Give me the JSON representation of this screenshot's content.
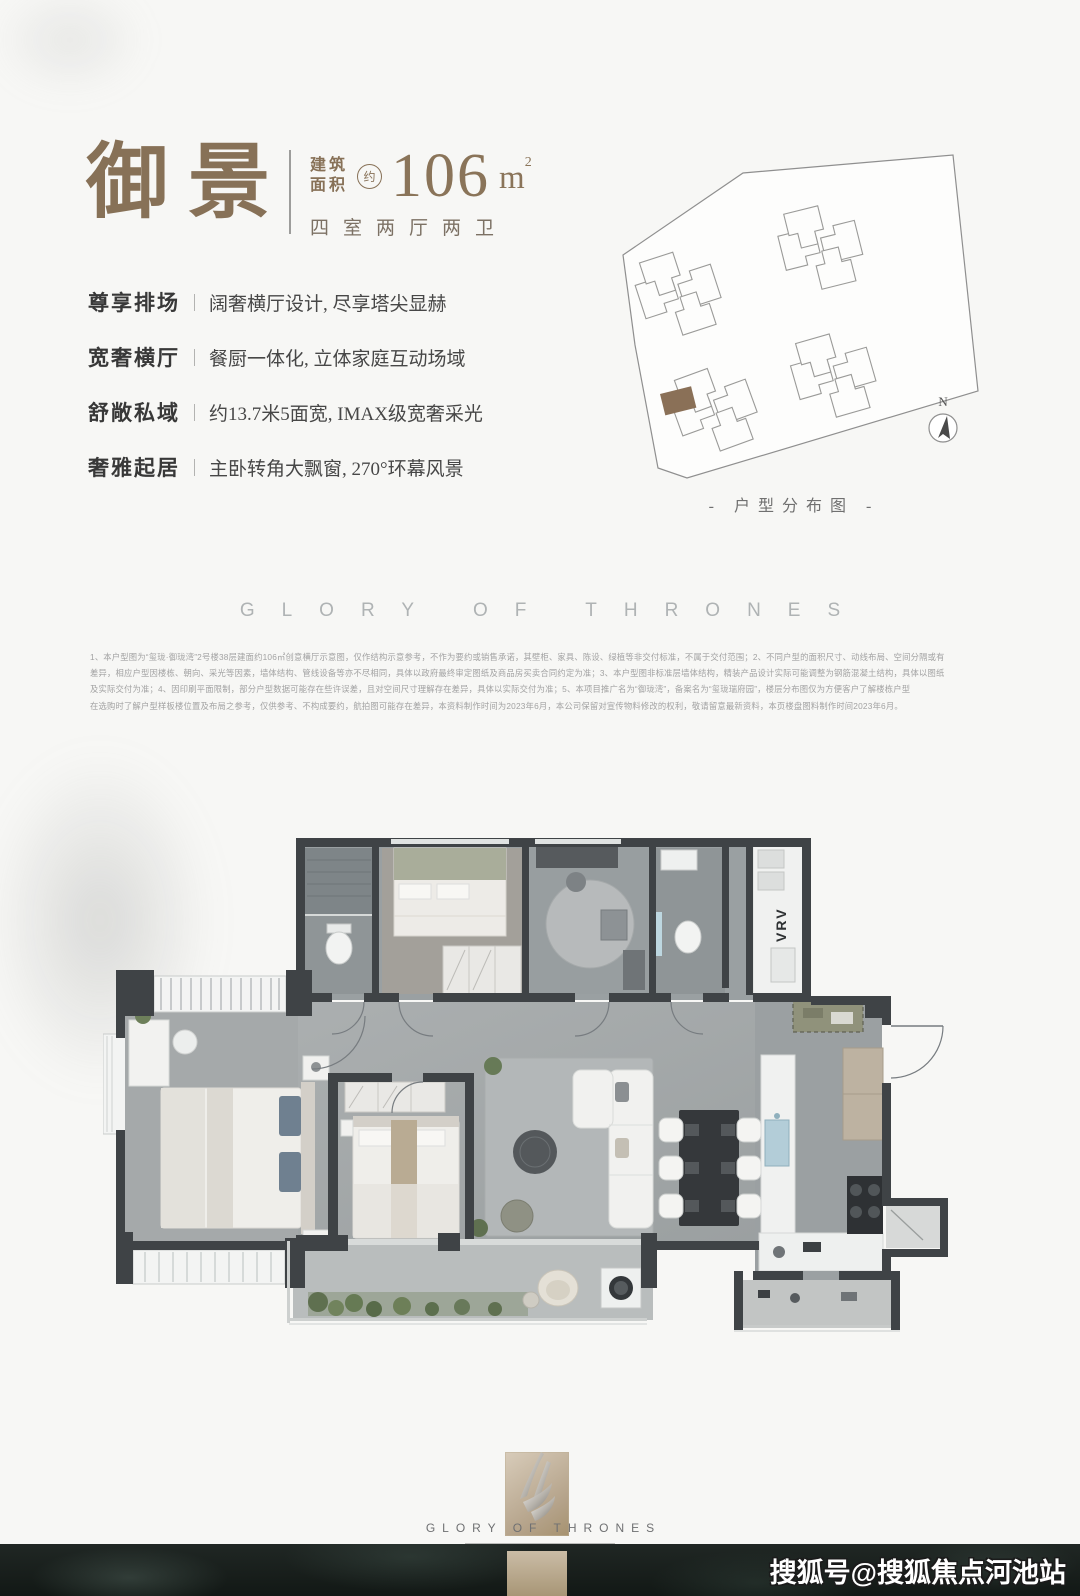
{
  "page": {
    "background": "#f7f7f5"
  },
  "header": {
    "title_char_1": "御",
    "title_char_2": "景",
    "area_label_top": "建筑",
    "area_label_bottom": "面积",
    "approx": "约",
    "area_value": "106",
    "area_unit": "m",
    "area_exponent": "2",
    "layout_summary": "四室两厅两卫",
    "accent_color": "#877157"
  },
  "features": [
    {
      "label": "尊享排场",
      "desc": "阔奢横厅设计, 尽享塔尖显赫"
    },
    {
      "label": "宽奢横厅",
      "desc": "餐厨一体化, 立体家庭互动场域"
    },
    {
      "label": "舒敞私域",
      "desc": "约13.7米5面宽, IMAX级宽奢采光"
    },
    {
      "label": "奢雅起居",
      "desc": "主卧转角大飘窗, 270°环幕风景"
    }
  ],
  "site_plan": {
    "caption": "- 户型分布图 -",
    "compass_label": "N",
    "highlight_color": "#8a7057",
    "outline_color": "#8f8f8f"
  },
  "brand_band": {
    "text": "GLORY OF THRONES"
  },
  "disclaimer": {
    "lines": [
      "1、本户型图为“玺珑·御珑湾”2号楼38层建面约106㎡创意横厅示意图，仅作结构示意参考，不作为要约或销售承诺，其壁柜、家具、陈设、绿植等非交付标准，不属于交付范围；2、不同户型的面积尺寸、动线布局、空间分隔或有",
      "差异，相应户型因楼栋、朝向、采光等因素，墙体结构、管线设备等亦不尽相同，具体以政府最终审定图纸及商品房买卖合同约定为准；3、本户型图非标准层墙体结构，精装产品设计实际可能调整为钢筋混凝土结构，具体以图纸",
      "及实际交付为准；4、因印刷平面限制，部分户型数据可能存在些许误差，且对空间尺寸理解存在差异，具体以实际交付为准；5、本项目推广名为“御珑湾”，备案名为“玺珑瑞府园”，楼层分布图仅为方便客户了解楼栋户型",
      "在选购时了解户型样板楼位置及布局之参考，仅供参考、不构成要约，航拍图可能存在差异，本资料制作时间为2023年6月，本公司保留对宣传物料修改的权利，敬请留意最新资料，本页楼盘图料制作时间2023年6月。"
    ]
  },
  "floor_plan": {
    "vrv_label": "VRV",
    "wall_color": "#3f4346"
  },
  "footer": {
    "brand": "GLORY OF THRONES",
    "watermark": "搜狐号@搜狐焦点河池站"
  }
}
